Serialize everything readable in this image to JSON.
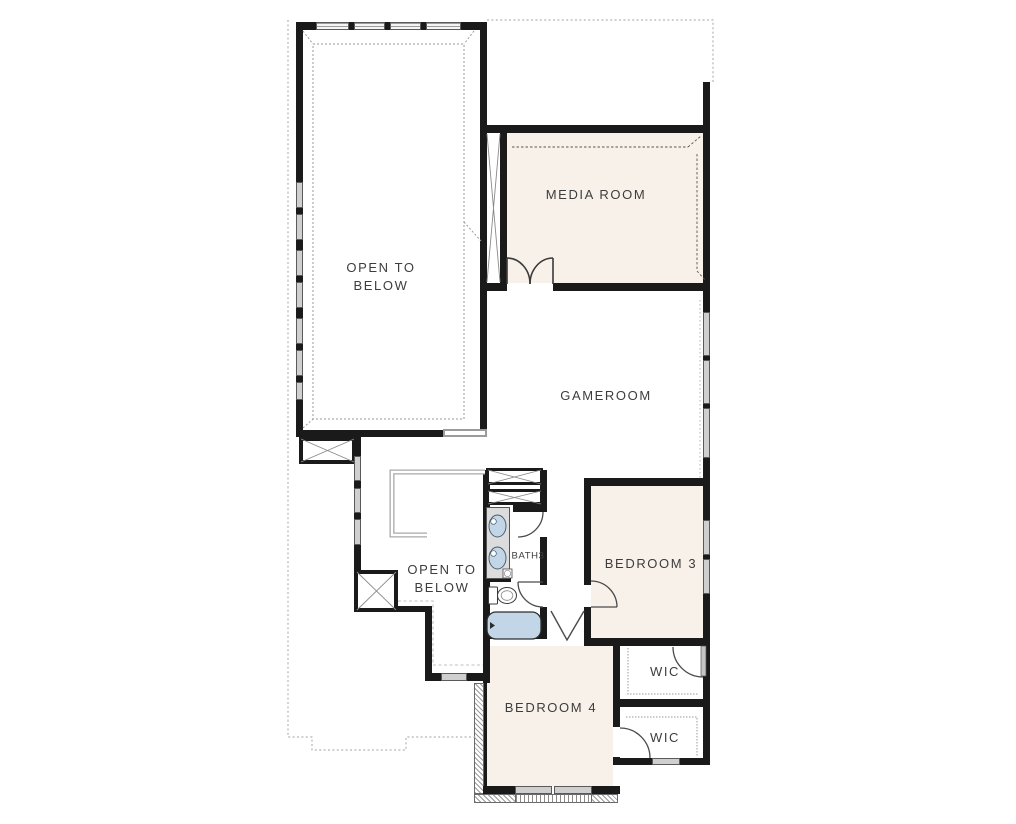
{
  "plan": {
    "title": "second-floor-plan",
    "rooms": {
      "open_to_below_upper": {
        "label_line1": "OPEN TO",
        "label_line2": "BELOW"
      },
      "media_room": {
        "label": "MEDIA ROOM"
      },
      "gameroom": {
        "label": "GAMEROOM"
      },
      "bath3": {
        "label": "BATH3"
      },
      "bedroom3": {
        "label": "BEDROOM 3"
      },
      "open_to_below_lower": {
        "label_line1": "OPEN TO",
        "label_line2": "BELOW"
      },
      "bedroom4": {
        "label": "BEDROOM 4"
      },
      "wic_upper": {
        "label": "WIC"
      },
      "wic_lower": {
        "label": "WIC"
      }
    },
    "colors": {
      "wall": "#1a1a1a",
      "room_fill": "#f8f1ea",
      "window_fill": "#cfcfcf",
      "fixture_blue": "#c2d6e8",
      "vanity_gray": "#dcdcdc",
      "dashed_gray": "#b5b5b5",
      "text": "#3d3d3d",
      "background": "#ffffff"
    }
  }
}
